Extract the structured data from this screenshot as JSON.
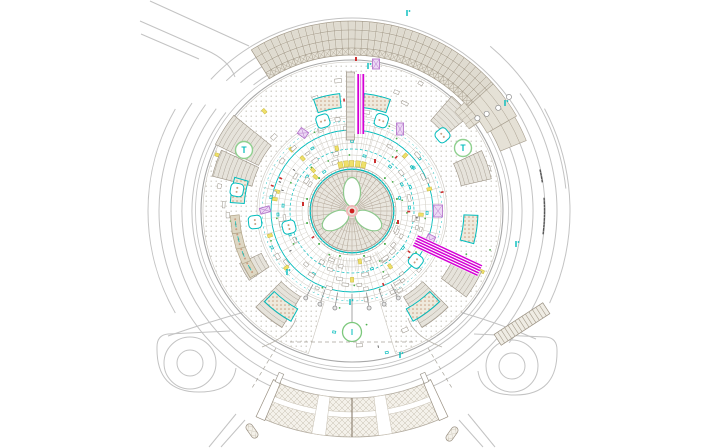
{
  "canvas": {
    "width": 704,
    "height": 448,
    "background": "#ffffff"
  },
  "center": {
    "x": 352,
    "y": 211
  },
  "palette": {
    "road": "#c3c3c3",
    "rim_dark": "#a8a8a8",
    "rim_light": "#c2c2c2",
    "grid_fill": "#dfdbd0",
    "grid_line": "#a69d8d",
    "band_fill": "#e5e1d6",
    "paving_dot": "#c5c1b8",
    "ring_gray": "#c9c5bb",
    "ring_gray2": "#d4d0c8",
    "cyan": "#00bcbc",
    "magenta": "#d400d4",
    "green": "#4db04d",
    "green_ring": "#8fd08f",
    "lavender_stroke": "#b678cc",
    "lavender_fill": "#edd9f5",
    "tan_fill": "#ded7c3",
    "tan_stroke": "#b1a488",
    "tan_dot": "#c79f82",
    "hatch_fill": "#e6e3db",
    "hatch_line": "#aaa295",
    "hatch_edge": "#9a9183",
    "cross_line": "#c6bfb0",
    "yellow_fill": "#efe06a",
    "yellow_stroke": "#c9b93e",
    "red": "#cc3030",
    "center_red": "#d02020",
    "center_halo": "#f0b8b8",
    "dome_fill": "#e9e6de",
    "dome_line": "#b2a698",
    "dark_dash": "#555555",
    "pole": "#8f8f8f",
    "white": "#ffffff"
  },
  "roads": {
    "lines": [
      "M150,1 L249,46",
      "M140,21 L206,50 Q229,60 235,77",
      "M141,34 L199,59"
    ],
    "arcs": [
      {
        "r": 160,
        "a1": -128,
        "a2": 218
      },
      {
        "r": 170,
        "a1": -131,
        "a2": 217
      },
      {
        "r": 181,
        "a1": -134,
        "a2": 216
      },
      {
        "r": 193,
        "a1": -137,
        "a2": 214
      },
      {
        "r": 215,
        "a1": -50,
        "a2": -6
      },
      {
        "r": 205,
        "a1": -35,
        "a2": 40
      },
      {
        "r": 218,
        "a1": -28,
        "a2": 25
      },
      {
        "r": 204,
        "a1": 150,
        "a2": 210
      }
    ],
    "connectors": [
      "M248,311 Q205,323 168,336",
      "M456,311 Q499,323 536,339"
    ],
    "stubs": [
      "M236,414 L209,447",
      "M245,420 L221,447",
      "M468,414 L495,447",
      "M459,420 L483,447"
    ],
    "pills": [
      {
        "x": 252,
        "y": 431,
        "rot": 55
      },
      {
        "x": 452,
        "y": 434,
        "rot": -55
      }
    ]
  },
  "loops": [
    {
      "cx": 190,
      "cy": 363,
      "r_in": 13,
      "r_mid": 26,
      "outer": "M230,331 L168,334 Q157,335 157,347 Q156,392 199,392 Q233,392 236,368"
    },
    {
      "cx": 512,
      "cy": 366,
      "r_in": 13,
      "r_mid": 26,
      "outer": "M474,334 L546,337 Q557,338 557,350 Q558,395 515,395 Q481,395 478,371"
    }
  ],
  "rims": [
    {
      "r": 151,
      "w": 1.1,
      "c": "#a8a8a8"
    },
    {
      "r": 156.5,
      "w": 0.8,
      "c": "#c2c2c2"
    }
  ],
  "paving": {
    "r1": 95,
    "r2": 149,
    "gap_a1": 73,
    "gap_a2": 107
  },
  "radials": {
    "step": 15,
    "r1": 47,
    "r2": 92,
    "skip": [
      -90,
      25,
      90
    ]
  },
  "fans": [
    {
      "a1": 58,
      "a2": 122,
      "step": 3.2,
      "r1": 47,
      "r2": 60,
      "c": "#c9c3b8"
    },
    {
      "a1": -118,
      "a2": -62,
      "step": 4,
      "r1": 62,
      "r2": 88,
      "c": "#d0ccc4"
    }
  ],
  "annotation_rings": [
    {
      "r": 50,
      "c": "#c9c5bb",
      "w": 0.5
    },
    {
      "r": 56,
      "c": "#c9c5bb",
      "w": 0.5
    },
    {
      "r": 62,
      "c": "#00bcbc",
      "w": 0.7,
      "dash": "3,2"
    },
    {
      "r": 68,
      "c": "#c9c5bb",
      "w": 0.5
    },
    {
      "r": 74,
      "c": "#c9c5bb",
      "w": 0.5
    },
    {
      "r": 81,
      "c": "#00bcbc",
      "w": 0.9
    },
    {
      "r": 87,
      "c": "#c9c5bb",
      "w": 0.5
    },
    {
      "r": 90,
      "c": "#00bcbc",
      "w": 0.5,
      "dash": "2,3"
    },
    {
      "r": 93,
      "c": "#d4d0c8",
      "w": 0.5
    }
  ],
  "scatter": {
    "seed": 42,
    "count": 165,
    "r_min": 47,
    "r_max": 93,
    "outer_frac": 0.22,
    "outer_r_min": 96,
    "outer_r_max": 146
  },
  "wedges": [
    {
      "a1": -154,
      "a2": -141,
      "r1": 104,
      "r2": 152
    },
    {
      "a1": -166,
      "a2": -155,
      "r1": 103,
      "r2": 144
    },
    {
      "a1": 121,
      "a2": 135,
      "r1": 100,
      "r2": 136
    },
    {
      "a1": 45,
      "a2": 59,
      "r1": 100,
      "r2": 136
    },
    {
      "a1": -25,
      "a2": -13,
      "r1": 112,
      "r2": 143
    },
    {
      "a1": 25,
      "a2": 37,
      "r1": 112,
      "r2": 143
    },
    {
      "a1": -49,
      "a2": -39,
      "r1": 120,
      "r2": 152
    },
    {
      "a1": 146,
      "a2": 155,
      "r1": 100,
      "r2": 124
    }
  ],
  "planter_arcs": [
    {
      "a1": -109,
      "a2": -96,
      "r1": 104,
      "r2": 118
    },
    {
      "a1": -84,
      "a2": -71,
      "r1": 104,
      "r2": 118
    },
    {
      "a1": 119,
      "a2": 134,
      "r1": 112,
      "r2": 126
    },
    {
      "a1": 46,
      "a2": 61,
      "r1": 112,
      "r2": 126
    },
    {
      "a1": 2,
      "a2": 15,
      "r1": 112,
      "r2": 126
    },
    {
      "a1": -176,
      "a2": -164,
      "r1": 108,
      "r2": 122
    }
  ],
  "tan_planters": {
    "angles": [
      151,
      158.5,
      166,
      173.5
    ],
    "r": 117,
    "w": 18,
    "h": 9
  },
  "rounded_squares": [
    {
      "a": -107.9,
      "r": 94.5
    },
    {
      "a": -72,
      "r": 95
    },
    {
      "a": -169.6,
      "r": 117
    },
    {
      "a": 173.5,
      "r": 97.6
    },
    {
      "a": 165.7,
      "r": 65
    },
    {
      "a": 38,
      "r": 81
    },
    {
      "a": -39.9,
      "r": 118
    }
  ],
  "lavender_rects": [
    {
      "x": 400,
      "y": 129,
      "w": 7,
      "h": 12,
      "rot": 0
    },
    {
      "x": 376,
      "y": 64,
      "w": 7,
      "h": 10,
      "rot": 0
    },
    {
      "x": 438,
      "y": 211,
      "w": 9,
      "h": 12,
      "rot": 0
    },
    {
      "x": 265,
      "y": 210,
      "w": 6,
      "h": 10,
      "rot": 75
    },
    {
      "x": 303,
      "y": 133,
      "w": 7,
      "h": 9,
      "rot": -55
    },
    {
      "x": 430,
      "y": 240,
      "w": 8,
      "h": 10,
      "rot": 25
    }
  ],
  "trees": [
    {
      "x": 244,
      "y": 150
    },
    {
      "x": 463,
      "y": 148
    }
  ],
  "grid_band": {
    "rows": [
      156,
      163,
      172,
      181,
      190
    ],
    "a1": -122,
    "a2": -42,
    "col_step": 2.2,
    "tails": [
      {
        "rows": [
          156,
          163,
          172,
          181,
          190
        ],
        "a1": -42,
        "a2": -30
      },
      {
        "rows": [
          160,
          172,
          181,
          188
        ],
        "a1": -30,
        "a2": -22
      }
    ],
    "patch": {
      "rows": [
        143,
        149.5,
        156
      ],
      "a1": -44,
      "a2": -35,
      "col_step": 2.2
    },
    "bubbles": [
      {
        "a": -36.5,
        "r": 156
      },
      {
        "a": -35.8,
        "r": 166
      },
      {
        "a": -35.2,
        "r": 179
      },
      {
        "a": -36,
        "r": 194
      }
    ]
  },
  "corridor_top": {
    "ladder": {
      "x": 346.5,
      "w": 8,
      "y1": 72,
      "y2": 140,
      "rung": 5
    },
    "stripes": {
      "xs": [
        358.2,
        363.3
      ],
      "y1": 74,
      "y2": 134,
      "w": 1.8,
      "thin_x": 360.8
    }
  },
  "corridor_right": {
    "a": 25,
    "r1": 70,
    "r2": 141,
    "offsets": [
      -5.2,
      -2.6,
      0,
      2.6,
      5.2
    ],
    "under_w": 13
  },
  "dome": {
    "r_rim": 40,
    "r_cyan": 41.8,
    "r_out": 44,
    "spokes": 48,
    "inner_rings": [
      13,
      21,
      29,
      35
    ],
    "petal_angles": [
      -90,
      30,
      150
    ],
    "petal": {
      "rc": 19,
      "rx": 8.5,
      "ry": 14.5
    },
    "green_dots": {
      "n": 12,
      "r": 46.5
    },
    "rim_ticks": 64
  },
  "yellow_row": {
    "angles": [
      -104,
      -97,
      -90.5,
      -83,
      -76
    ],
    "r": 47.5
  },
  "poles": {
    "angles": [
      62,
      71,
      80,
      100,
      109,
      118
    ],
    "r1": 83,
    "r2": 96,
    "dot_at": 98.5,
    "center": {
      "a": 90,
      "r1": 83,
      "r2": 114,
      "dot_at": 117
    },
    "green_circle": {
      "a": 90,
      "r": 121,
      "rad": 9.5
    }
  },
  "apron": {
    "flares": [
      "M296,318 C292,332 278,341 262,347",
      "M408,318 C412,332 426,341 442,347"
    ],
    "dashed": [
      "M290,342 L414,342",
      "M276,348 L252,388",
      "M428,348 L452,388"
    ]
  },
  "bottom_band": {
    "r1": 187,
    "r2": 226,
    "a1": 67,
    "a2": 113,
    "white_stripe": [
      201,
      206.5
    ],
    "dividers": [
      81.5,
      98.5
    ],
    "divider_w": 3.5,
    "center_a": 90,
    "caps": [
      66.2,
      113.8
    ],
    "corner_ticks": [
      113.5,
      66.5
    ]
  },
  "stair_band": {
    "cx": 522,
    "cy": 324,
    "len": 58,
    "wid": 13,
    "rot": -33,
    "steps": 14
  },
  "cyan_marks": [
    {
      "x": 407,
      "y": 13
    },
    {
      "x": 368,
      "y": 66
    },
    {
      "x": 505,
      "y": 103
    },
    {
      "x": 400,
      "y": 355
    },
    {
      "x": 287,
      "y": 272
    },
    {
      "x": 516,
      "y": 244
    },
    {
      "x": 350,
      "y": 302
    }
  ],
  "red_marks": [
    {
      "x": 356,
      "y": 59
    },
    {
      "x": 375,
      "y": 161
    },
    {
      "x": 303,
      "y": 204
    },
    {
      "x": 398,
      "y": 222
    }
  ],
  "dim_dashes": [
    {
      "r": 192.5,
      "a1": -3.5,
      "a2": 6.5,
      "n": 11
    },
    {
      "r": 192.5,
      "a1": -12,
      "a2": -9,
      "n": 4
    }
  ]
}
